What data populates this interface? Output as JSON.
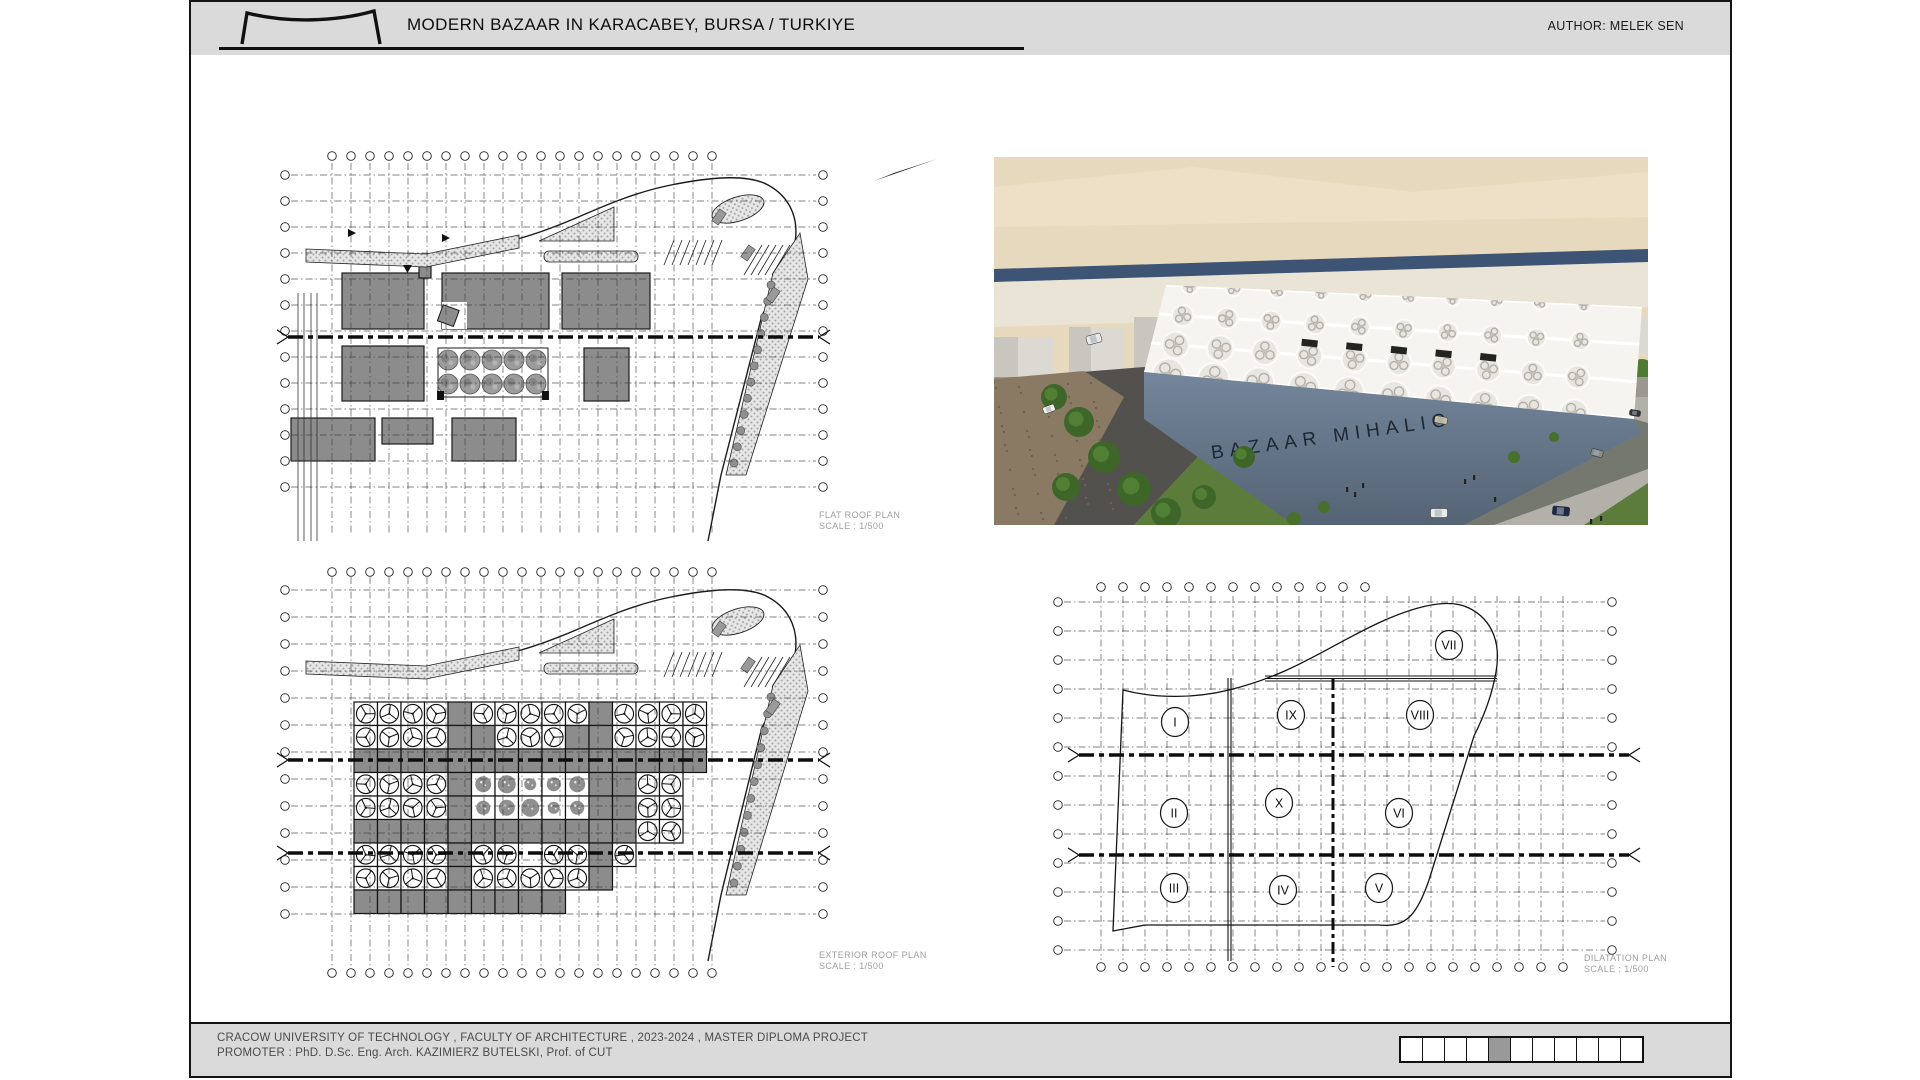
{
  "header": {
    "title": "MODERN BAZAAR IN KARACABEY, BURSA / TURKIYE",
    "author": "AUTHOR: MELEK SEN"
  },
  "render": {
    "building_sign": "BAZAAR MIHALIC"
  },
  "plans": {
    "flat_roof": {
      "title": "FLAT ROOF PLAN",
      "scale": "SCALE : 1/500"
    },
    "exterior_roof": {
      "title": "EXTERIOR ROOF PLAN",
      "scale": "SCALE : 1/500"
    },
    "dilatation": {
      "title": "DILATATION PLAN",
      "scale": "SCALE : 1/500",
      "zones": [
        "VII",
        "I",
        "IX",
        "VIII",
        "II",
        "X",
        "VI",
        "III",
        "IV",
        "V"
      ]
    }
  },
  "footer": {
    "line1": "CRACOW UNIVERSITY OF TECHNOLOGY , FACULTY OF ARCHITECTURE , 2023-2024 , MASTER DIPLOMA PROJECT",
    "line2": "PROMOTER : PhD. D.Sc. Eng. Arch. KAZIMIERZ BUTELSKI, Prof. of CUT",
    "scale_bar": {
      "cells": 11,
      "filled_index": 5
    },
    "colors": {
      "bar_fill": "#999999",
      "panel_gray": "#dadada",
      "plan_block_gray": "#8c8c8c",
      "facade_slate": "#64778c"
    }
  }
}
